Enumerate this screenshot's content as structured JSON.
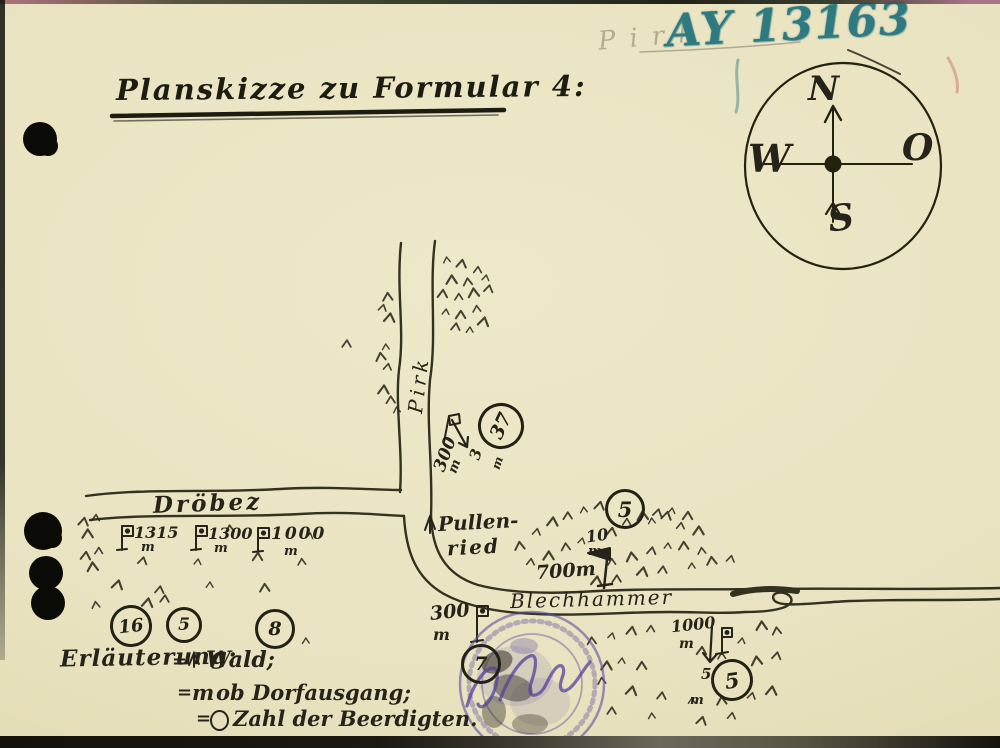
{
  "header": {
    "title": "Planskizze zu Formular 4:",
    "archive_number": "AY 13163",
    "pencil_note": "Pirk"
  },
  "compass": {
    "north": "N",
    "east": "O",
    "south": "S",
    "west": "W"
  },
  "roads": {
    "vertical": "Pirk",
    "west": "Dröbez",
    "east": "Blechhammer"
  },
  "village": {
    "line1": "Pullen-",
    "line2": "ried"
  },
  "distance_markers": [
    {
      "value": "1315",
      "unit": "m"
    },
    {
      "value": "1300",
      "unit": "m"
    },
    {
      "value": "1000",
      "unit": "m"
    },
    {
      "value": "300",
      "unit": "m"
    },
    {
      "value": "3",
      "unit": "m"
    },
    {
      "value": "10",
      "unit": "m"
    },
    {
      "value": "700",
      "unit": "m"
    },
    {
      "value": "300",
      "unit": "m"
    },
    {
      "value": "1000",
      "unit": "m"
    },
    {
      "value": "5",
      "unit": "m"
    }
  ],
  "burial_counts": [
    "37",
    "5",
    "16",
    "5",
    "8",
    "7",
    "5"
  ],
  "legend": {
    "heading": "Erläuterung:",
    "equals": "=",
    "items": [
      {
        "symbol": "wald-tree-mark",
        "label": "Wald;"
      },
      {
        "symbol": "m",
        "label": "ob Dorfausgang;"
      },
      {
        "symbol": "circle-mark",
        "label": "Zahl der Beerdigten."
      }
    ]
  },
  "colors": {
    "ink": "#26241a",
    "paper": "#e9e3c1",
    "crayon_blue": "#2e7a80",
    "stamp_purple": "#6a5ca8"
  }
}
